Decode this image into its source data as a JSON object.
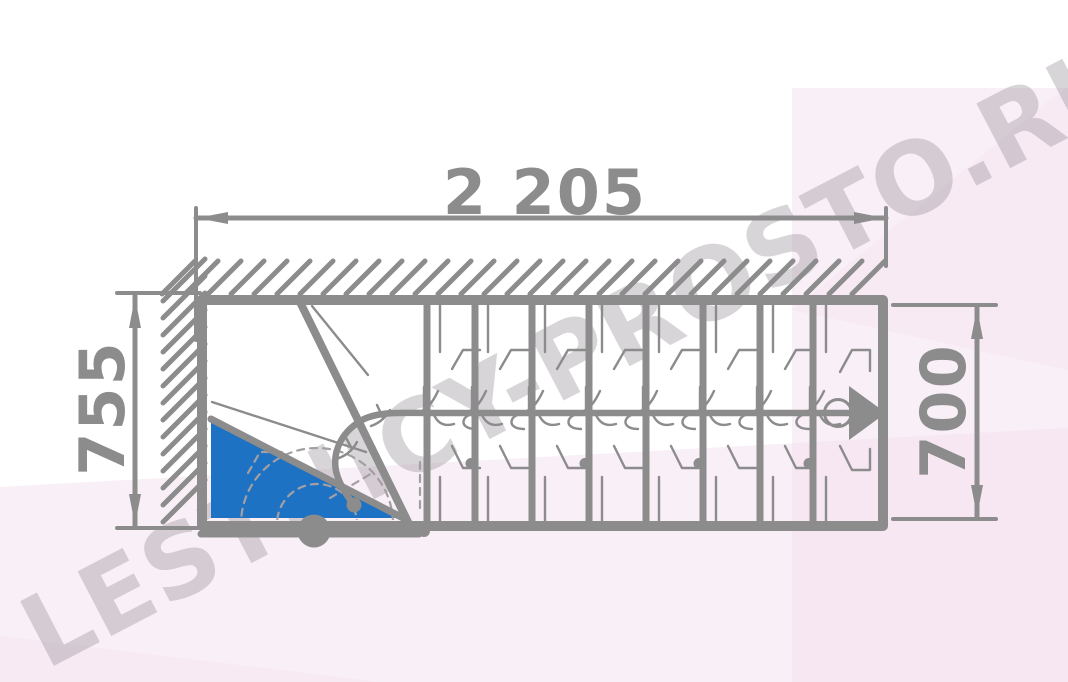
{
  "page": {
    "title": "Staircase top-view plan drawing"
  },
  "watermark": {
    "text": "LESTNICY-PROSTO.RU"
  },
  "dimensions": {
    "total_length_mm": "2 205",
    "left_width_mm": "755",
    "right_width_mm": "700"
  },
  "stair": {
    "type": "quarter-turn staircase plan, top view",
    "winder_steps": 3,
    "straight_treads": 8,
    "first_step_highlighted": true,
    "walk_line_direction": "right"
  },
  "colors": {
    "line": "#8c8c8c",
    "blue": "#1e72c4",
    "pink": "#f3dfed",
    "watermark": "#8f8791",
    "dash": "#a39fa3",
    "paper": "#ffffff"
  }
}
